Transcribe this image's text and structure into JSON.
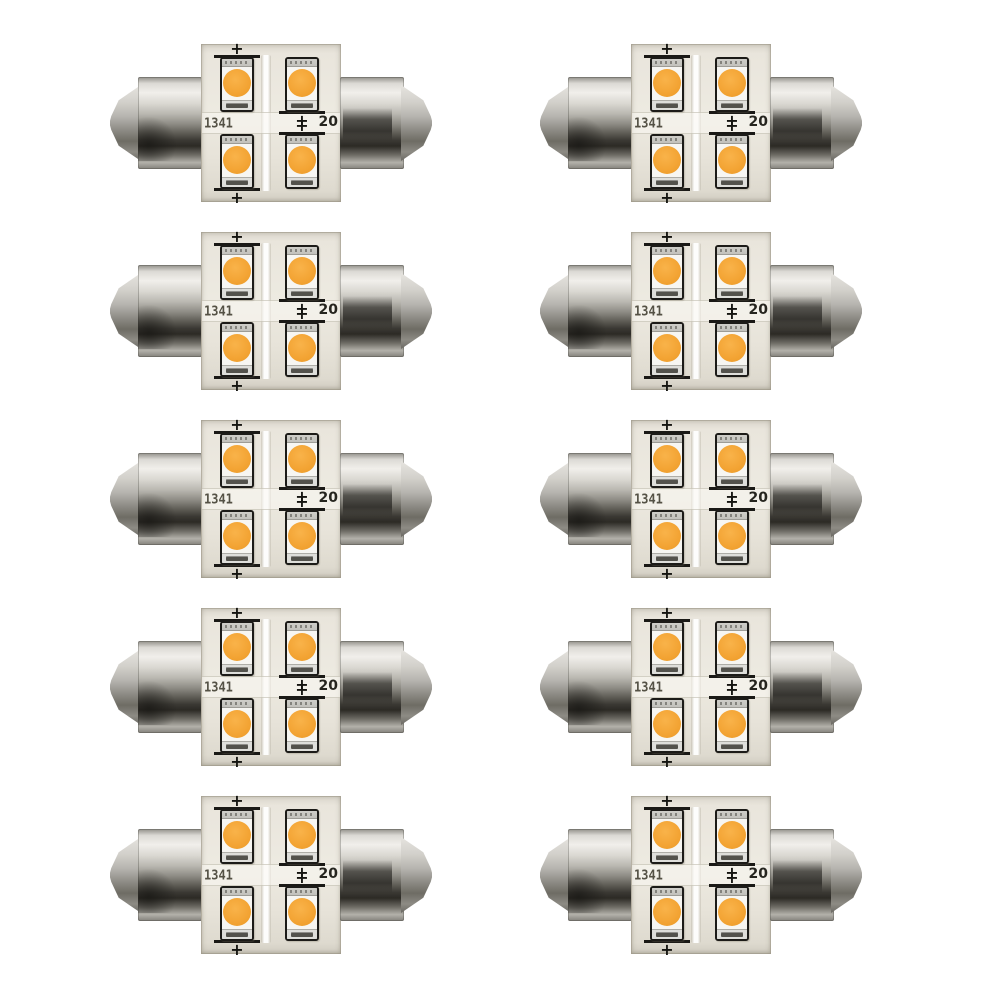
{
  "page": {
    "background": "#ffffff",
    "content": "product-photo"
  },
  "product": {
    "name": "festoon-led-bulb",
    "quantity": 10,
    "grid_rows": 5,
    "grid_cols": 2,
    "leds_per_bulb": 4,
    "pcb_marking_datecode": "1341",
    "pcb_marking_right": "20",
    "polarity_mark": "+",
    "colors": {
      "background": "#ffffff",
      "pcb": "#e9e5dc",
      "led_dome_amber": "#f3a434",
      "led_package_outline": "#1c1b18",
      "metal_highlight": "#f1efeb",
      "metal_shadow": "#2c2a25"
    }
  }
}
